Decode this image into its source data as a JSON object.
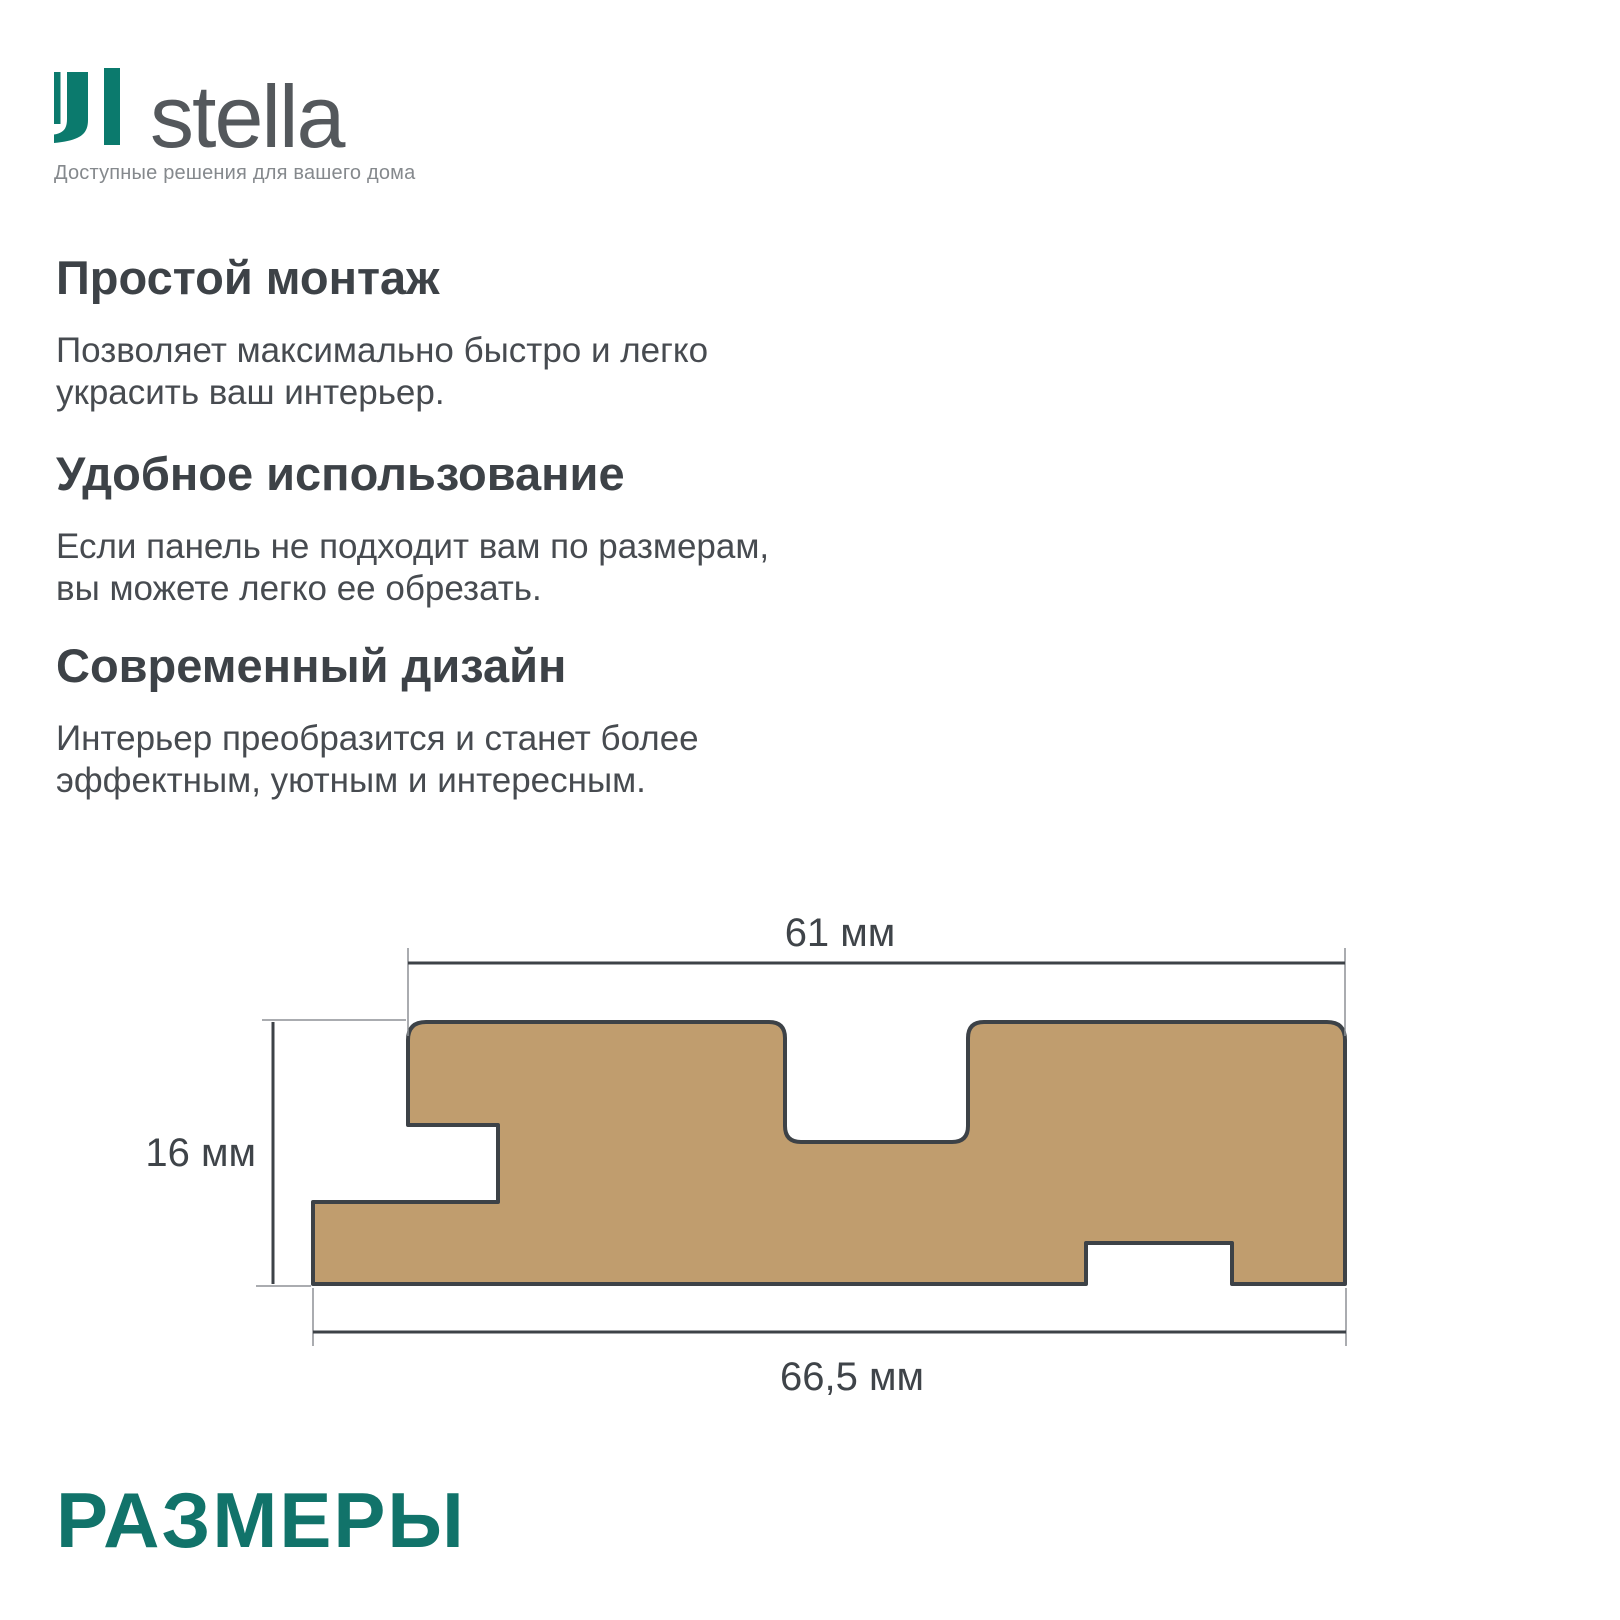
{
  "logo": {
    "brand": "stella",
    "tagline": "Доступные решения для вашего дома",
    "icon": "stella-monogram",
    "accent_color": "#0b7a6d",
    "brand_text_color": "#54585c"
  },
  "features": [
    {
      "title": "Простой монтаж",
      "body": "Позволяет максимально быстро и легко\nукрасить ваш интерьер."
    },
    {
      "title": "Удобное использование",
      "body": "Если панель не подходит вам по размерам,\nвы можете легко ее обрезать."
    },
    {
      "title": "Современный дизайн",
      "body": "Интерьер преобразится и станет более\nэффектным, уютным и интересным."
    }
  ],
  "diagram": {
    "type": "panel-cross-section",
    "dimensions": {
      "top_width": "61 мм",
      "height": "16 мм",
      "bottom_width": "66,5 мм"
    },
    "panel_fill_color": "#c09d6e",
    "outline_color": "#3d4247"
  },
  "section_title": "РАЗМЕРЫ",
  "colors": {
    "accent_teal": "#11736a",
    "heading": "#3d4247",
    "body_text": "#474b50",
    "tagline": "#85898d",
    "dimension_label": "#3f4449"
  }
}
